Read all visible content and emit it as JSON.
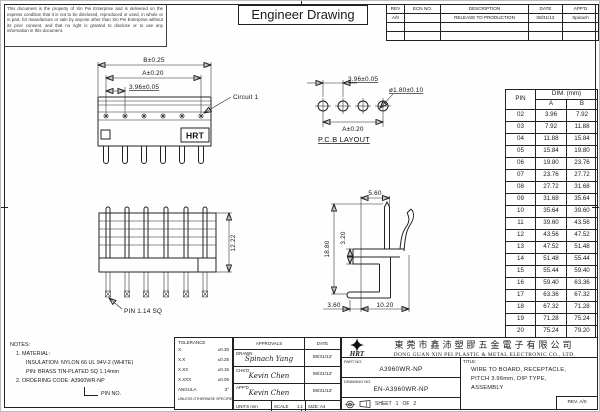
{
  "sheet": {
    "title": "Engineer Drawing",
    "disclaimer": "This document is the property of Xin Pei Enterprise and is delivered on the express condition that it is not to be disclosed, reproduced or used, in whole or in part, for manufacture or sale by anyone other than Xin Pei Enterprise without its prior consent, and that no right is granted to disclose or to use any information in this document."
  },
  "revision_table": {
    "headers": [
      "REV",
      "ECN NO.",
      "DESCRIPTION",
      "DATE",
      "APP'D"
    ],
    "rows": [
      {
        "rev": "A/0",
        "ecn": "",
        "description": "RELEASE TO PRODUCTION",
        "date": "08/31/12",
        "appd": "Spinach"
      }
    ]
  },
  "views": {
    "front": {
      "dim_b": "B±0.25",
      "dim_a": "A±0.20",
      "dim_pitch": "3.96±0.05",
      "circuit_label": "Circuit 1",
      "logo": "HRT"
    },
    "pcb": {
      "label": "P.C.B LAYOUT",
      "dim_pitch": "3.96±0.05",
      "dim_hole": "ø1.80±0.10",
      "dim_a": "A±0.20"
    },
    "profile": {
      "dim_height": "12.22",
      "pin_label": "PIN 1.14 SQ"
    },
    "terminal": {
      "dim_top": "5.60",
      "dim_height": "18.80",
      "dim_gap": "3.20",
      "dim_foot_left": "3.60",
      "dim_foot": "10.20"
    }
  },
  "pin_table": {
    "col_pin": "PIN",
    "col_dim": "DIM. (mm)",
    "col_a": "A",
    "col_b": "B",
    "rows": [
      {
        "pin": "02",
        "a": "3.96",
        "b": "7.92"
      },
      {
        "pin": "03",
        "a": "7.92",
        "b": "11.88"
      },
      {
        "pin": "04",
        "a": "11.88",
        "b": "15.84"
      },
      {
        "pin": "05",
        "a": "15.84",
        "b": "19.80"
      },
      {
        "pin": "06",
        "a": "19.80",
        "b": "23.76"
      },
      {
        "pin": "07",
        "a": "23.76",
        "b": "27.72"
      },
      {
        "pin": "08",
        "a": "27.72",
        "b": "31.68"
      },
      {
        "pin": "09",
        "a": "31.68",
        "b": "35.64"
      },
      {
        "pin": "10",
        "a": "35.64",
        "b": "39.60"
      },
      {
        "pin": "11",
        "a": "39.60",
        "b": "43.56"
      },
      {
        "pin": "12",
        "a": "43.56",
        "b": "47.52"
      },
      {
        "pin": "13",
        "a": "47.52",
        "b": "51.48"
      },
      {
        "pin": "14",
        "a": "51.48",
        "b": "55.44"
      },
      {
        "pin": "15",
        "a": "55.44",
        "b": "59.40"
      },
      {
        "pin": "16",
        "a": "59.40",
        "b": "63.36"
      },
      {
        "pin": "17",
        "a": "63.36",
        "b": "67.32"
      },
      {
        "pin": "18",
        "a": "67.32",
        "b": "71.28"
      },
      {
        "pin": "19",
        "a": "71.28",
        "b": "75.24"
      },
      {
        "pin": "20",
        "a": "75.24",
        "b": "79.20"
      }
    ]
  },
  "notes": {
    "heading": "NOTES:",
    "line1": "1. MATERIAL:",
    "line2": "INSULATION: NYLON 66 UL 94V-2 (WHITE)",
    "line3": "PIN: BRASS TIN-PLATED SQ 1.14mm",
    "line4": "2. ORDERING CODE: A3960WR-NP",
    "pin_no_label": "PIN NO."
  },
  "tolerance": {
    "heading": "TOLERANCE",
    "rows": [
      {
        "k": "X.",
        "v": "±0.30"
      },
      {
        "k": "X.X",
        "v": "±0.25"
      },
      {
        "k": "X.XX",
        "v": "±0.15"
      },
      {
        "k": "X.XXX",
        "v": "±0.05"
      },
      {
        "k": "ANGULA",
        "v": "3°"
      }
    ],
    "footnote": "UNLESS OTHERWISE SPECIFIED"
  },
  "approvals": {
    "heading": "APPROVALS",
    "date_heading": "DATE",
    "rows": [
      {
        "role": "DRAWN",
        "name": "Spinach Yang",
        "date": "08/31/12'"
      },
      {
        "role": "CHK'D",
        "name": "Kevin Chen",
        "date": "08/31/12'"
      },
      {
        "role": "APP'D",
        "name": "Kevin Chen",
        "date": "08/31/12'"
      }
    ],
    "units": "UNITS mm",
    "scale_label": "SCALE",
    "scale_value": "1:1",
    "size": "SIZE: A4"
  },
  "company": {
    "logo_text": "HRT",
    "name_cn": "東莞市鑫沛塑膠五金電子有限公司",
    "name_en": "DONG GUAN XIN PEI PLASTIC & METAL ELECTRONIC CO., LTD.",
    "part_no_label": "PART NO.",
    "part_no": "A3960WR-NP",
    "drawing_no_label": "DRAWING NO.",
    "drawing_no": "EN-A3960WR-NP",
    "sheet_label": "SHEET",
    "sheet_no": "1",
    "sheet_of": "OF",
    "sheet_total": "2",
    "title_label": "TITLE:",
    "title_line1": "WIRE TO BOARD, RECEPTACLE,",
    "title_line2": "PITCH 3.96mm, DIP TYPE,",
    "title_line3": "ASSEMBLY",
    "rev": "REV. A/0"
  }
}
